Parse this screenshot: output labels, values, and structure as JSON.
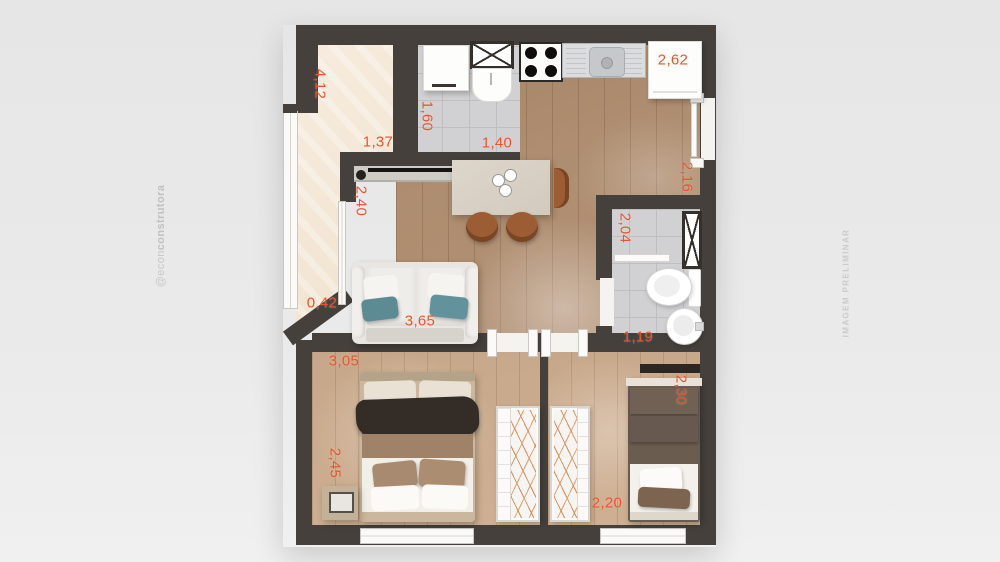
{
  "watermarks": {
    "left_handle_light": "@econ",
    "left_handle_bold": "construtora",
    "right_notice": "IMAGEM PRELIMINAR"
  },
  "dimensions": {
    "balcony_length": "4,12",
    "balcony_width": "1,37",
    "balcony_end_width": "0,42",
    "service_depth": "1,60",
    "service_width": "1,40",
    "kitchen_run": "2,62",
    "entry_wall": "2,16",
    "tv_wall": "2,40",
    "sofa_wall": "3,65",
    "bath_depth": "2,04",
    "bath_width": "1,19",
    "bedroom1_width": "3,05",
    "bedroom1_depth": "2,45",
    "bedroom2_depth": "2,30",
    "bedroom2_width": "2,20"
  },
  "colors": {
    "background": "#e9e9e9",
    "wall": "#45403b",
    "dimension_text": "#e8552c",
    "balcony_floor": "#f4e8d9",
    "tile_floor": "#d1d1d3",
    "living_wood": "#b09074",
    "bedroom_wood": "#cbac8e",
    "watermark": "#c8c8c8",
    "pillow_teal": "#5d8b94",
    "chair_wood": "#9c5c34"
  }
}
